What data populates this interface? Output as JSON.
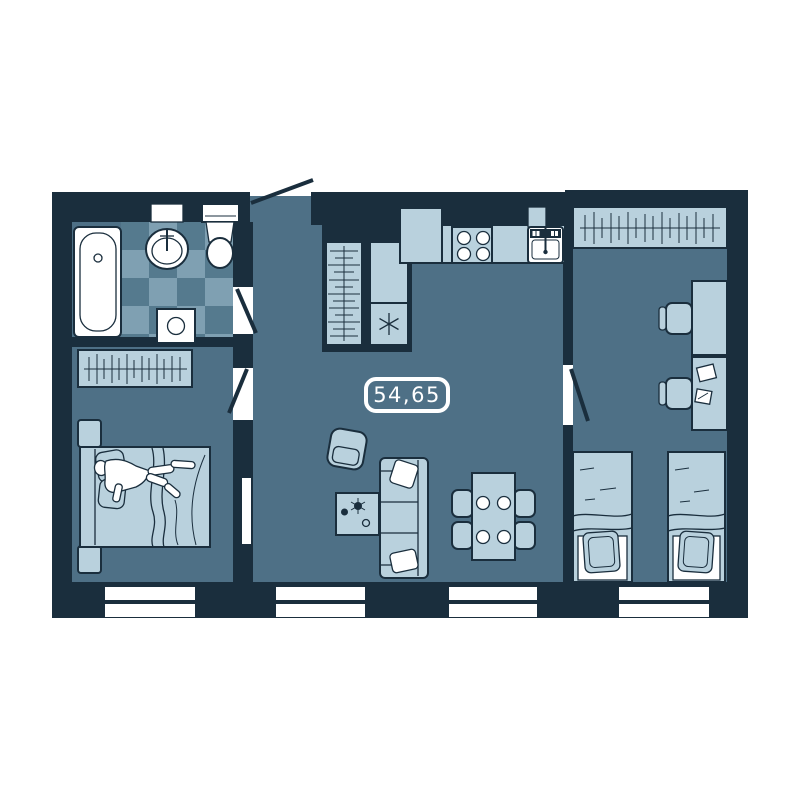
{
  "plan": {
    "area_label": "54,65"
  },
  "colors": {
    "wall": "#1a2e3d",
    "floor": "#4e7086",
    "furniture_light": "#b9d1dd",
    "tile_light": "#7fa0b2",
    "tile_dark": "#557a8e",
    "fixture_white": "#ffffff",
    "page_background": "#ffffff"
  },
  "rooms": {
    "bathroom": {
      "floor_style": "checkerboard-tiles",
      "fixtures": [
        "bathtub",
        "wash-basin",
        "toilet",
        "washing-machine"
      ]
    },
    "bedroom": {
      "furniture": [
        "wardrobe-with-hangers",
        "nightstand",
        "double-bed-with-person",
        "nightstand"
      ],
      "windows": 1
    },
    "hallway": {
      "furniture": [
        "closet-with-hangers"
      ],
      "entrance_door": true
    },
    "kitchen_living_room": {
      "furniture": [
        "refrigerator",
        "kitchen-counter",
        "stove-four-burners",
        "kitchen-sink",
        "armchair",
        "coffee-table",
        "sofa",
        "dining-table",
        "dining-chairs-x4"
      ],
      "windows": 2
    },
    "kids_room": {
      "furniture": [
        "wardrobe-with-hangers",
        "desk",
        "desk-chair",
        "desk-with-papers",
        "desk-chair",
        "single-bed",
        "single-bed"
      ],
      "windows": 1
    }
  },
  "counts": {
    "windows": 4,
    "interior_doors": 3,
    "entrance_doors": 1
  }
}
